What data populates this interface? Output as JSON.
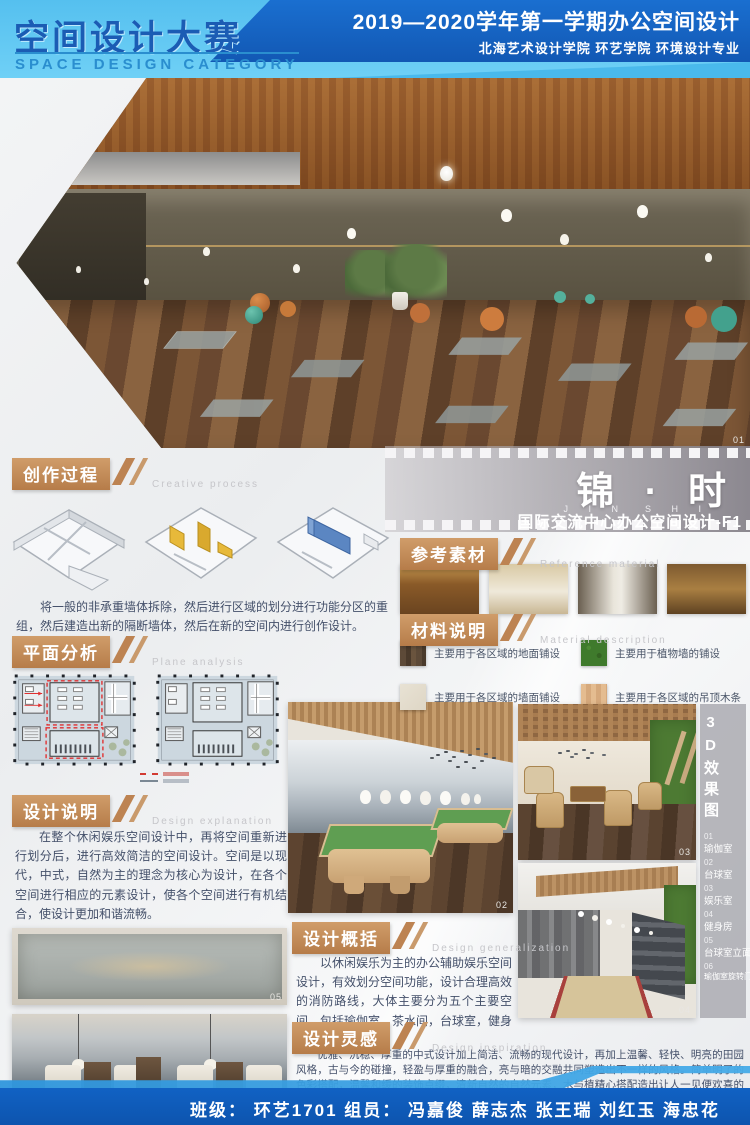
{
  "header": {
    "title_cn": "空间设计大赛",
    "title_en": "SPACE DESIGN CATEGORY",
    "course": "2019—2020学年第一学期办公空间设计",
    "school": "北海艺术设计学院  环艺学院  环境设计专业"
  },
  "title_block": {
    "name_cn": "锦 · 时",
    "name_en": "J I N　S H I",
    "caption": "国际交流中心办公空间设计-F1"
  },
  "sections": {
    "creative": {
      "cn": "创作过程",
      "en": "Creative process",
      "caption": "将一般的非承重墙体拆除，然后进行区域的划分进行功能分区的重组，然后建造出新的隔断墙体，然后在新的空间内进行创作设计。"
    },
    "plane": {
      "cn": "平面分析",
      "en": "Plane analysis"
    },
    "explain": {
      "cn": "设计说明",
      "en": "Design explanation",
      "para1": "在整个休闲娱乐空间设计中，再将空间重新进行划分后，进行高效简洁的空间设计。空间是以现代，中式，自然为主的理念为核心为设计，在各个空间进行相应的元素设计，使各个空间进行有机结合，使设计更加和谐流畅。",
      "para2": "在各个空间的设计中使用了大量的木结构元素，与各空间进行有机结合。设计之中主要采取大量木色，绿植和玻璃。使设计更有层次感。"
    },
    "reference": {
      "cn": "参考素材",
      "en": "Reference material"
    },
    "material": {
      "cn": "材料说明",
      "en": "Material description",
      "items": [
        {
          "label": "主要用于各区域的地面铺设"
        },
        {
          "label": "主要用于植物墙的铺设"
        },
        {
          "label": "主要用于各区域的墙面铺设"
        },
        {
          "label": "主要用于各区域的吊顶木条"
        }
      ]
    },
    "summary": {
      "cn": "设计概括",
      "en": "Design generalization",
      "para": "以休闲娱乐为主的办公辅助娱乐空间设计，有效划分空间功能，设计合理高效的消防路线，大体主要分为五个主要空间，包括瑜伽室，茶水间，台球室，健身房，更衣间。"
    },
    "inspiration": {
      "cn": "设计灵感",
      "en": "Design inspiration",
      "para": "优雅、沉稳、厚重的中式设计加上简洁、流畅的现代设计，再加上温馨、轻快、明亮的田园风格，古与今的碰撞，轻盈与厚重的融合，亮与暗的交融共同塑造出不一样的风格。简单明了的色彩搭配，温馨和缓的装饰点缀，清新自然的自然元素，木与植精心搭配造出让人一见便欢喜的空间设计。"
    }
  },
  "index": {
    "title": "3D效果图",
    "items": [
      {
        "num": "01",
        "label": "瑜伽室"
      },
      {
        "num": "02",
        "label": "台球室"
      },
      {
        "num": "03",
        "label": "娱乐室"
      },
      {
        "num": "04",
        "label": "健身房"
      },
      {
        "num": "05",
        "label": "台球室立面"
      },
      {
        "num": "06",
        "label": "瑜伽室旋转门"
      }
    ]
  },
  "labels": {
    "hero": "01",
    "billiards": "02",
    "lounge": "03",
    "gym": "04",
    "elev1": "05",
    "elev2": "06"
  },
  "footer": {
    "text": "班级： 环艺1701   组员： 冯嘉俊  薛志杰  张王瑞  刘红玉  海忠花"
  },
  "colors": {
    "banner_light": "#5ec6f2",
    "banner_dark": "#1467c8",
    "accent_tan": "#c08a58",
    "footer_blue": "#0f5fc0"
  }
}
